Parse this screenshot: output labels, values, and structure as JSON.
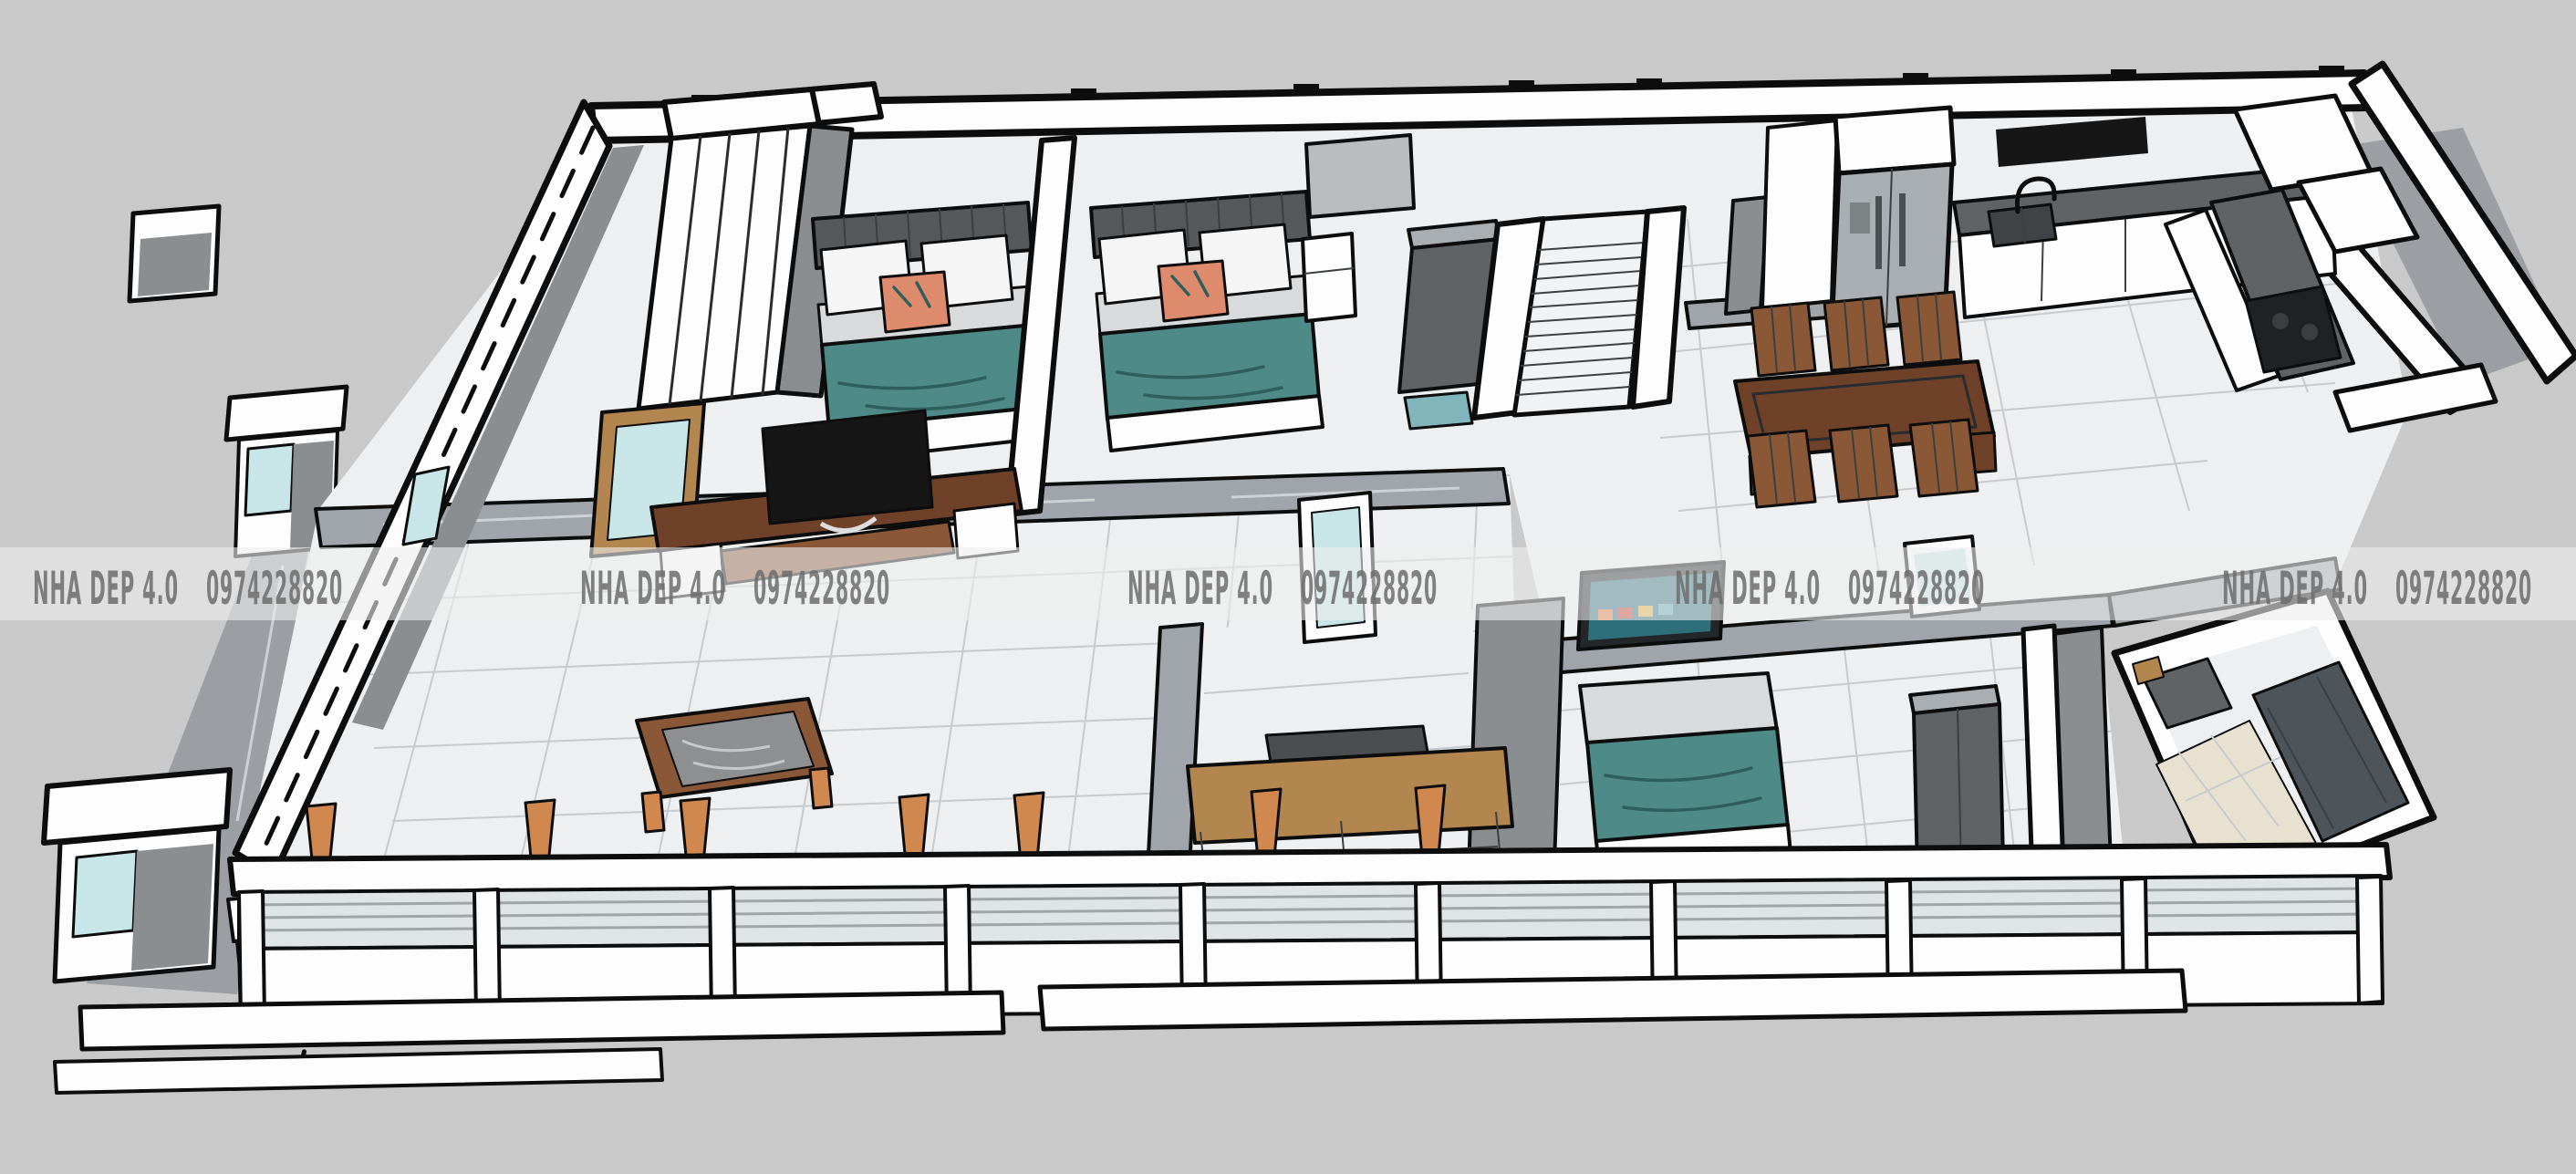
{
  "title": "3D cutaway floor plan rendering of a single-storey house",
  "watermark": {
    "brand": "NHA DEP 4.0",
    "phone": "0974228820",
    "repetitions": 5
  },
  "scene": {
    "colors": {
      "background": "#c9c9c9",
      "ink": "#0d0d0d",
      "wall": "#fdfdfd",
      "wall_gray": "#8a8e91",
      "wall_gray_dark": "#5f6366",
      "floor": "#edeff0",
      "floor_line": "#c6cbcf",
      "marble_band": "#9fa5aa",
      "stone": "#9b9fa3",
      "teal": "#4e8a87",
      "teal_dark": "#2f5f5d",
      "teal_glass": "#c8e6e7",
      "wood_dark": "#6f4129",
      "wood_mid": "#8a5836",
      "wood_light": "#b3854f",
      "orange": "#d0884e",
      "steel": "#a9aeb3",
      "black": "#161616",
      "beige": "#e8e1d0",
      "pillow": "#f5f5f5",
      "mattress": "#d9dadb",
      "louver": "#dfe4e6",
      "louver_line": "#9fa6a9",
      "screen_teal": "#2e6f7a",
      "wm_band": "rgba(238,238,238,0.6)",
      "wm_text": "rgba(108,108,108,0.85)"
    },
    "objects": [
      {
        "id": "bedroom-1",
        "items": [
          "wardrobe",
          "double-bed",
          "teal-blanket",
          "pillows",
          "accent-pillow"
        ]
      },
      {
        "id": "bedroom-2",
        "items": [
          "double-bed",
          "nightstand",
          "gray-wardrobe",
          "cabinet"
        ]
      },
      {
        "id": "hallway",
        "items": [
          "staircase",
          "teal-doormat"
        ]
      },
      {
        "id": "kitchen",
        "items": [
          "refrigerator",
          "range-hood",
          "sink-with-faucet",
          "l-shaped-counter",
          "cooktop",
          "upper-cabinets"
        ]
      },
      {
        "id": "dining-area",
        "items": [
          "wooden-dining-table",
          "six-wooden-chairs"
        ]
      },
      {
        "id": "living-room",
        "items": [
          "tv-console",
          "television",
          "coffee-table",
          "glass-doors"
        ]
      },
      {
        "id": "study-room",
        "items": [
          "wooden-desk",
          "dark-chair"
        ]
      },
      {
        "id": "master-bedroom",
        "items": [
          "double-bed",
          "wall-mounted-tv",
          "dark-wardrobe",
          "glass-door"
        ]
      },
      {
        "id": "bathroom",
        "items": [
          "shower-enclosure",
          "beige-tile-floor",
          "vanity-shelf"
        ]
      },
      {
        "id": "exterior",
        "items": [
          "gate-pillars",
          "ornamental-gate",
          "stone-terrace",
          "front-facade-louvers",
          "fence-bands",
          "section-cut-line",
          "porch-steps"
        ]
      }
    ]
  }
}
